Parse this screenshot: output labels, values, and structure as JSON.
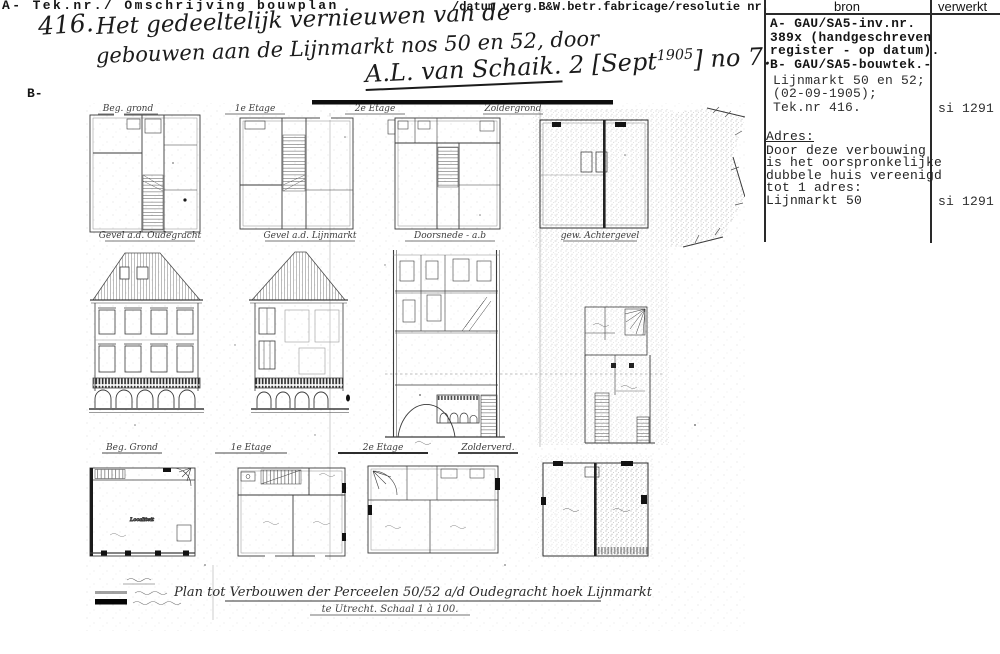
{
  "header": {
    "left": "A- Tek.nr./ Omschrijving bouwplan",
    "right": "/datum verg.B&W.betr.fabricage/resolutie nr.",
    "b_label": "B-"
  },
  "annotation": {
    "num": "416.",
    "line1": "Het gedeeltelijk vernieuwen van de",
    "line2": "gebouwen aan de Lijnmarkt nos 50 en 52, door",
    "signature": "A.L. van Schaik.",
    "sig_rest_a": "2 [Sept",
    "sig_sup": "1905",
    "sig_rest_b": "] no 7."
  },
  "source_table": {
    "col_bron": "bron",
    "col_verwerkt": "verwerkt",
    "bold_lines": [
      "A- GAU/SA5-inv.nr.",
      "389x (handgeschreven",
      "register - op datum).",
      "B- GAU/SA5-bouwtek.-"
    ],
    "entry_lines": [
      "Lijnmarkt 50 en 52;",
      "(02-09-1905);",
      "Tek.nr 416."
    ],
    "entry_verwerkt": "si 1291",
    "adres_label": "Adres:",
    "adres_lines": [
      "Door deze verbouwing",
      "is het oorspronkelijke",
      "dubbele huis vereenigd",
      "tot 1 adres:",
      "Lijnmarkt 50"
    ],
    "adres_verwerkt": "si 1291"
  },
  "drawing": {
    "row1_labels": [
      "Beg. grond",
      "1e Etage",
      "2e Etage",
      "Zoldergrond"
    ],
    "row2_labels": [
      "Gevel a.d. Oudegracht",
      "Gevel a.d. Lijnmarkt",
      "Doorsnede - a.b",
      "gew. Achtergevel"
    ],
    "row3_labels": [
      "Beg. Grond",
      "1e Etage",
      "2e Etage",
      "Zolderverd."
    ],
    "room_label": "Localiteit",
    "caption_line1": "Plan tot Verbouwen der Perceelen 50/52 a/d Oudegracht hoek Lijnmarkt",
    "caption_line2": "te Utrecht.  Schaal 1 à 100."
  }
}
